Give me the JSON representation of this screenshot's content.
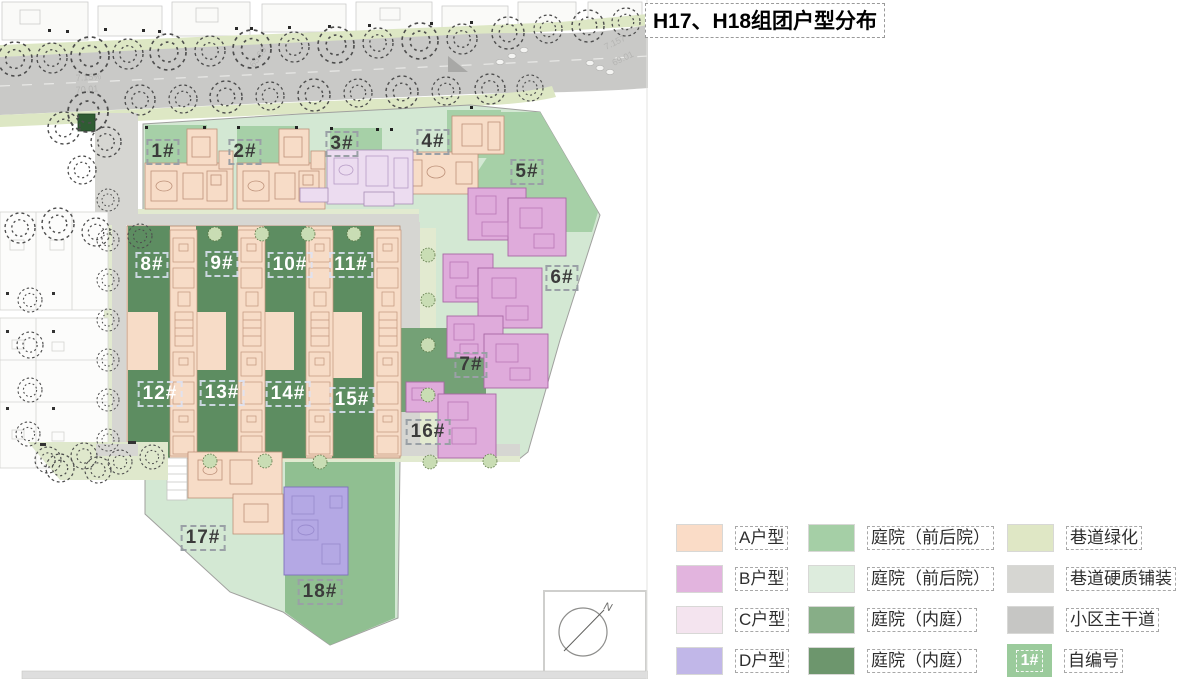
{
  "title": "H17、H18组团户型分布",
  "plan": {
    "buildings": [
      {
        "label": "1#"
      },
      {
        "label": "2#"
      },
      {
        "label": "3#"
      },
      {
        "label": "4#"
      },
      {
        "label": "5#"
      },
      {
        "label": "6#"
      },
      {
        "label": "7#"
      },
      {
        "label": "8#"
      },
      {
        "label": "9#"
      },
      {
        "label": "10#"
      },
      {
        "label": "11#"
      },
      {
        "label": "12#"
      },
      {
        "label": "13#"
      },
      {
        "label": "14#"
      },
      {
        "label": "15#"
      },
      {
        "label": "16#"
      },
      {
        "label": "17#"
      },
      {
        "label": "18#"
      }
    ],
    "road_labels": [
      "7.15%",
      "70.01",
      "65.60",
      "7.157",
      "69.01"
    ],
    "north": "N"
  },
  "legend": {
    "unit_types": [
      {
        "label": "A户型",
        "color": "#fadcc7"
      },
      {
        "label": "B户型",
        "color": "#e2b4de"
      },
      {
        "label": "C户型",
        "color": "#f4e4ef"
      },
      {
        "label": "D户型",
        "color": "#c1b7e8"
      }
    ],
    "courtyards": [
      {
        "label": "庭院（前后院）",
        "color": "#a5cfa6"
      },
      {
        "label": "庭院（前后院）",
        "color": "#ddecdd"
      },
      {
        "label": "庭院（内庭）",
        "color": "#87ae87"
      },
      {
        "label": "庭院（内庭）",
        "color": "#6d966d"
      }
    ],
    "roads": [
      {
        "label": "巷道绿化",
        "color": "#dfe7c5"
      },
      {
        "label": "巷道硬质铺装",
        "color": "#d6d6d2"
      },
      {
        "label": "小区主干道",
        "color": "#c6c6c4"
      }
    ],
    "number_key": {
      "chip": "1#",
      "chip_color": "#9bcb9c",
      "label": "自编号"
    }
  }
}
